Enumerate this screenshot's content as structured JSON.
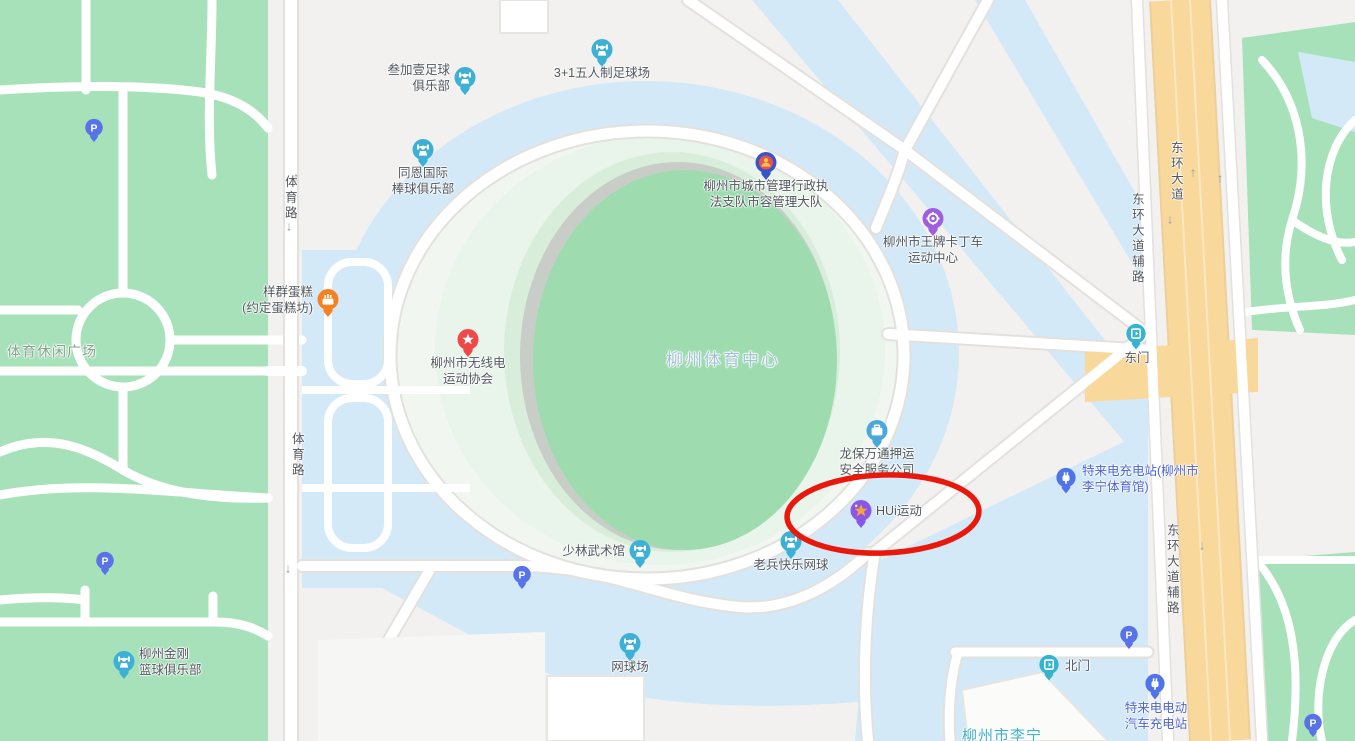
{
  "map": {
    "colors": {
      "land": "#f2f1ef",
      "park": "#a7e1ba",
      "plaza": "#d3e9f7",
      "road": "#ffffff",
      "road_casing": "#e2e1de",
      "road_main": "#f9d89b",
      "road_main_casing": "#eccf9b",
      "road_main_line": "#fbe8c2",
      "stadium_green": "#9edcb0",
      "stadium_gray": "#c9cdc8",
      "stadium_rim": "#d8eedb",
      "stadium_pale": "#e9f4ea",
      "inner_pale": "#f1f6f1",
      "building": "#fbfbfa",
      "building_edge": "#e6e5e2",
      "label": "#51575e",
      "label_blue": "#4c63d2",
      "label_park": "#7fa489",
      "label_aoi": "#a3c3d4",
      "label_teal": "#43b0c8",
      "annotation": "#e8180c",
      "pin_sports": "#3cb0d5",
      "pin_parking": "#5873e8",
      "pin_star": "#f04848",
      "pin_gov": "#3953c8",
      "pin_kart": "#9d5fe0",
      "pin_hui": "#8a56e8",
      "pin_hui_star": "#f8a23e",
      "pin_security": "#4aa7dc",
      "pin_cake": "#f58220",
      "pin_charging": "#4f74e8",
      "pin_gate": "#35b3cf"
    },
    "annotation": {
      "shape": "ellipse",
      "target": "HUi运动",
      "color": "#e8180c",
      "cx": 883,
      "cy": 514,
      "rx": 96,
      "ry": 39
    },
    "area_labels": [
      {
        "text": "体育路",
        "x": 289,
        "y": 198,
        "orientation": "vertical",
        "style": "road"
      },
      {
        "text": "体育路",
        "x": 296,
        "y": 455,
        "orientation": "vertical",
        "style": "road"
      },
      {
        "text": "东环大道",
        "x": 1175,
        "y": 172,
        "orientation": "vertical",
        "style": "road"
      },
      {
        "text": "东环大道辅路",
        "x": 1136,
        "y": 239,
        "orientation": "vertical",
        "style": "road"
      },
      {
        "text": "东环大道辅路",
        "x": 1171,
        "y": 570,
        "orientation": "vertical",
        "style": "road"
      },
      {
        "text": "体育休闲广场",
        "x": 52,
        "y": 352,
        "orientation": "horizontal",
        "style": "area-park"
      },
      {
        "text": "柳州体育中心",
        "x": 723,
        "y": 360,
        "orientation": "horizontal",
        "style": "area-aoi"
      },
      {
        "text": "柳州市李宁",
        "x": 1002,
        "y": 737,
        "orientation": "horizontal",
        "style": "area-teal"
      }
    ],
    "pois": [
      {
        "id": "sanjiayi-football-club",
        "icon": "sports",
        "x": 465,
        "y": 78,
        "label_pos": "left",
        "lines": [
          "叁加壹足球",
          "俱乐部"
        ]
      },
      {
        "id": "3plus1-football-field",
        "icon": "sports",
        "x": 602,
        "y": 50,
        "label_pos": "below",
        "lines": [
          "3+1五人制足球场"
        ]
      },
      {
        "id": "tongen-baseball-club",
        "icon": "sports",
        "x": 423,
        "y": 150,
        "label_pos": "below",
        "lines": [
          "同恩国际",
          "棒球俱乐部"
        ]
      },
      {
        "id": "yangqun-cake-shop",
        "icon": "cake",
        "x": 328,
        "y": 300,
        "label_pos": "left",
        "lines": [
          "样群蛋糕",
          "(约定蛋糕坊)"
        ]
      },
      {
        "id": "radio-sports-association",
        "icon": "star",
        "x": 468,
        "y": 340,
        "label_pos": "below",
        "lines": [
          "柳州市无线电",
          "运动协会"
        ]
      },
      {
        "id": "city-management-brigade",
        "icon": "gov",
        "x": 766,
        "y": 163,
        "label_pos": "below",
        "lines": [
          "柳州市城市管理行政执",
          "法支队市容管理大队"
        ]
      },
      {
        "id": "wangpai-karting-center",
        "icon": "kart",
        "x": 933,
        "y": 219,
        "label_pos": "below",
        "lines": [
          "柳州市王牌卡丁车",
          "运动中心"
        ]
      },
      {
        "id": "longbao-escort-company",
        "icon": "security",
        "x": 877,
        "y": 431,
        "label_pos": "below",
        "lines": [
          "龙保万通押运",
          "安全服务公司"
        ]
      },
      {
        "id": "hui-sports",
        "icon": "hui",
        "x": 861,
        "y": 511,
        "label_pos": "right",
        "lines": [
          "HUi运动"
        ]
      },
      {
        "id": "laobing-tennis",
        "icon": "sports",
        "x": 791,
        "y": 542,
        "label_pos": "below",
        "lines": [
          "老兵快乐网球"
        ]
      },
      {
        "id": "shaolin-martial-arts",
        "icon": "sports",
        "x": 640,
        "y": 551,
        "label_pos": "left",
        "lines": [
          "少林武术馆"
        ]
      },
      {
        "id": "tennis-court",
        "icon": "sports",
        "x": 630,
        "y": 644,
        "label_pos": "below",
        "lines": [
          "网球场"
        ]
      },
      {
        "id": "jingang-basketball-club",
        "icon": "sports",
        "x": 124,
        "y": 662,
        "label_pos": "right",
        "lines": [
          "柳州金刚",
          "篮球俱乐部"
        ]
      },
      {
        "id": "teld-charging-lining",
        "icon": "charging",
        "x": 1067,
        "y": 479,
        "label_pos": "right",
        "lines": [
          "特来电充电站(柳州市",
          "李宁体育馆)"
        ],
        "label_color": "blue"
      },
      {
        "id": "teld-ev-charging",
        "icon": "charging",
        "x": 1156,
        "y": 685,
        "label_pos": "below",
        "lines": [
          "特来电电动",
          "汽车充电站"
        ],
        "label_color": "blue"
      },
      {
        "id": "east-gate",
        "icon": "gate",
        "x": 1137,
        "y": 335,
        "label_pos": "below",
        "lines": [
          "东门"
        ]
      },
      {
        "id": "north-gate",
        "icon": "gate",
        "x": 1050,
        "y": 666,
        "label_pos": "right",
        "lines": [
          "北门"
        ]
      },
      {
        "id": "parking-1",
        "icon": "parking",
        "x": 96,
        "y": 130,
        "label_pos": "none",
        "lines": []
      },
      {
        "id": "parking-2",
        "icon": "parking",
        "x": 107,
        "y": 563,
        "label_pos": "none",
        "lines": []
      },
      {
        "id": "parking-3",
        "icon": "parking",
        "x": 524,
        "y": 577,
        "label_pos": "none",
        "lines": []
      },
      {
        "id": "parking-4",
        "icon": "parking",
        "x": 1131,
        "y": 637,
        "label_pos": "none",
        "lines": []
      },
      {
        "id": "parking-5",
        "icon": "parking",
        "x": 1315,
        "y": 725,
        "label_pos": "none",
        "lines": []
      }
    ],
    "arrows": [
      {
        "x": 296,
        "y": 177,
        "dir": "up"
      },
      {
        "x": 289,
        "y": 226,
        "dir": "down"
      },
      {
        "x": 299,
        "y": 437,
        "dir": "up"
      },
      {
        "x": 288,
        "y": 568,
        "dir": "down"
      },
      {
        "x": 1193,
        "y": 172,
        "dir": "up"
      },
      {
        "x": 1220,
        "y": 178,
        "dir": "up"
      },
      {
        "x": 1170,
        "y": 219,
        "dir": "down"
      },
      {
        "x": 1202,
        "y": 545,
        "dir": "down"
      }
    ]
  }
}
